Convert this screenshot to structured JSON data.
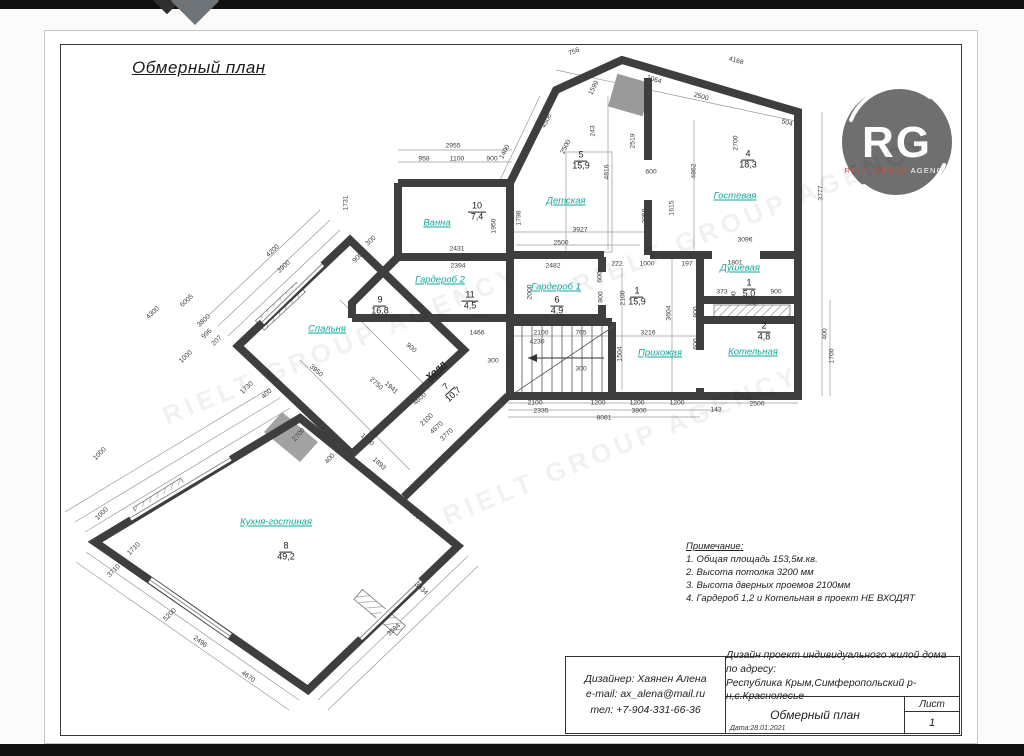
{
  "page": {
    "title": "Обмерный план"
  },
  "logo": {
    "initials": "RG",
    "line1": "RIELT GROUP",
    "line2": " AGENCY",
    "circle_color": "#6f6f6f",
    "accent_color": "#cf4d42"
  },
  "watermark": {
    "text": "RIELT GROUP AGENCY"
  },
  "colors": {
    "wall": "#3e3e3e",
    "room_label": "#12a89a",
    "thin_line": "#8a8a8a"
  },
  "notes": {
    "heading": "Примечание:",
    "items": [
      "1. Общая площадь  153,5м.кв.",
      "2. Высота потолка 3200 мм",
      "3.  Высота дверных проемов 2100мм",
      "4. Гардероб 1,2 и Котельная в проект НЕ ВХОДЯТ"
    ]
  },
  "titleblock": {
    "designer_lines": [
      "Дизайнер: Хаянен Алена",
      "e-mail: ax_alena@mail.ru",
      "тел: +7-904-331-66-36"
    ],
    "project_lines": [
      "Дизайн проект индивидуального жилой дома по адресу:",
      "Республика Крым,Симферопольский р-н,с.Краснолесье"
    ],
    "doc_title": "Обмерный план",
    "date_label": "Дата:28.01.2021",
    "sheet_label": "Лист",
    "sheet_number": "1"
  },
  "plan": {
    "rooms": [
      {
        "name": "Ванна",
        "number": "10",
        "area": "7,4",
        "lx": 437,
        "ly": 223,
        "fx": 477,
        "fy": 212,
        "rot": 0,
        "color": "teal"
      },
      {
        "name": "Детская",
        "number": "5",
        "area": "15,9",
        "lx": 566,
        "ly": 201,
        "fx": 581,
        "fy": 161,
        "rot": 0,
        "color": "teal"
      },
      {
        "name": "Гостевая",
        "number": "4",
        "area": "18,3",
        "lx": 735,
        "ly": 196,
        "fx": 748,
        "fy": 160,
        "rot": 0,
        "color": "teal"
      },
      {
        "name": "Гардероб 2",
        "number": "11",
        "area": "4,5",
        "lx": 440,
        "ly": 280,
        "fx": 470,
        "fy": 301,
        "rot": 0,
        "color": "teal"
      },
      {
        "name": "Гардероб 1",
        "number": "6",
        "area": "4,9",
        "lx": 556,
        "ly": 287,
        "fx": 557,
        "fy": 306,
        "rot": 0,
        "color": "teal"
      },
      {
        "name": "Прихожая",
        "number": "1",
        "area": "15,9",
        "lx": 660,
        "ly": 353,
        "fx": 637,
        "fy": 297,
        "rot": 0,
        "color": "teal"
      },
      {
        "name": "Душевая",
        "number": "1",
        "area": "5,0",
        "lx": 740,
        "ly": 268,
        "fx": 749,
        "fy": 289,
        "rot": 0,
        "color": "teal"
      },
      {
        "name": "Котельная",
        "number": "2",
        "area": "4,8",
        "lx": 753,
        "ly": 352,
        "fx": 764,
        "fy": 332,
        "rot": 0,
        "color": "teal"
      },
      {
        "name": "Холл",
        "number": "7",
        "area": "10,7",
        "lx": 436,
        "ly": 371,
        "fx": 450,
        "fy": 391,
        "rot": -43,
        "color": "dark"
      },
      {
        "name": "Спальня",
        "number": "9",
        "area": "16,8",
        "lx": 327,
        "ly": 329,
        "fx": 380,
        "fy": 306,
        "rot": 0,
        "color": "teal"
      },
      {
        "name": "Кухня-гостиная",
        "number": "8",
        "area": "49,2",
        "lx": 276,
        "ly": 522,
        "fx": 286,
        "fy": 552,
        "rot": 0,
        "color": "teal"
      }
    ],
    "dimensions": [
      [
        "756",
        574,
        52,
        -22
      ],
      [
        "1064",
        654,
        80,
        16
      ],
      [
        "4168",
        736,
        61,
        16
      ],
      [
        "2500",
        701,
        97,
        16
      ],
      [
        "504",
        787,
        123,
        16
      ],
      [
        "1400",
        505,
        152,
        -63
      ],
      [
        "1599",
        594,
        88,
        -63
      ],
      [
        "4506",
        547,
        121,
        -63
      ],
      [
        "2500",
        566,
        147,
        -63
      ],
      [
        "243",
        593,
        131,
        -90
      ],
      [
        "2519",
        633,
        141,
        -90
      ],
      [
        "2700",
        736,
        143,
        -90
      ],
      [
        "4862",
        694,
        171,
        -90
      ],
      [
        "4816",
        607,
        172,
        -90
      ],
      [
        "3777",
        821,
        193,
        -90
      ],
      [
        "600",
        651,
        172,
        0
      ],
      [
        "1615",
        672,
        208,
        -90
      ],
      [
        "2058",
        645,
        216,
        -90
      ],
      [
        "1798",
        519,
        218,
        -90
      ],
      [
        "3927",
        580,
        230,
        0
      ],
      [
        "2500",
        561,
        243,
        0
      ],
      [
        "3096",
        745,
        240,
        0
      ],
      [
        "2955",
        453,
        146,
        0
      ],
      [
        "958",
        424,
        159,
        0
      ],
      [
        "1100",
        457,
        159,
        0
      ],
      [
        "900",
        492,
        159,
        0
      ],
      [
        "1731",
        346,
        203,
        -90
      ],
      [
        "300",
        371,
        241,
        -45
      ],
      [
        "900",
        358,
        258,
        -45
      ],
      [
        "2431",
        457,
        249,
        0
      ],
      [
        "2394",
        458,
        266,
        0
      ],
      [
        "1950",
        494,
        226,
        -90
      ],
      [
        "2482",
        553,
        266,
        0
      ],
      [
        "2039",
        511,
        292,
        -90
      ],
      [
        "2000",
        530,
        292,
        -90
      ],
      [
        "1308",
        479,
        318,
        0
      ],
      [
        "600",
        600,
        277,
        -90
      ],
      [
        "800",
        601,
        297,
        -90
      ],
      [
        "222",
        617,
        264,
        0
      ],
      [
        "1000",
        647,
        264,
        0
      ],
      [
        "197",
        687,
        264,
        0
      ],
      [
        "1801",
        735,
        263,
        0
      ],
      [
        "2100",
        623,
        298,
        -90
      ],
      [
        "3604",
        669,
        313,
        -90
      ],
      [
        "3216",
        648,
        333,
        0
      ],
      [
        "1504",
        620,
        354,
        -90
      ],
      [
        "800",
        696,
        312,
        -90
      ],
      [
        "600",
        696,
        344,
        -90
      ],
      [
        "373",
        722,
        292,
        0
      ],
      [
        "930",
        752,
        304,
        0
      ],
      [
        "900",
        776,
        292,
        0
      ],
      [
        "100",
        778,
        301,
        0
      ],
      [
        "200",
        734,
        297,
        -90
      ],
      [
        "400",
        825,
        334,
        -90
      ],
      [
        "1700",
        832,
        356,
        -90
      ],
      [
        "1466",
        477,
        333,
        0
      ],
      [
        "2100",
        541,
        333,
        0
      ],
      [
        "765",
        581,
        333,
        0
      ],
      [
        "4230",
        537,
        342,
        0
      ],
      [
        "1504",
        512,
        356,
        -90
      ],
      [
        "300",
        493,
        361,
        0
      ],
      [
        "300",
        581,
        369,
        0
      ],
      [
        "2100",
        535,
        403,
        0
      ],
      [
        "2335",
        541,
        411,
        0
      ],
      [
        "1200",
        598,
        403,
        0
      ],
      [
        "1200",
        637,
        403,
        0
      ],
      [
        "1200",
        677,
        403,
        0
      ],
      [
        "3800",
        639,
        411,
        0
      ],
      [
        "143",
        716,
        410,
        0
      ],
      [
        "8081",
        604,
        418,
        0
      ],
      [
        "2500",
        757,
        404,
        0
      ],
      [
        "4200",
        273,
        251,
        -43
      ],
      [
        "3900",
        284,
        267,
        -43
      ],
      [
        "6005",
        187,
        301,
        -43
      ],
      [
        "3800",
        204,
        321,
        -43
      ],
      [
        "4300",
        153,
        313,
        -43
      ],
      [
        "996",
        207,
        334,
        -43
      ],
      [
        "207",
        217,
        341,
        -43
      ],
      [
        "1000",
        186,
        357,
        -43
      ],
      [
        "1730",
        247,
        388,
        -43
      ],
      [
        "400",
        267,
        394,
        -43
      ],
      [
        "3950",
        316,
        371,
        42
      ],
      [
        "2750",
        376,
        384,
        42
      ],
      [
        "1941",
        391,
        388,
        42
      ],
      [
        "900",
        411,
        348,
        42
      ],
      [
        "4600",
        420,
        399,
        -43
      ],
      [
        "2100",
        427,
        420,
        -43
      ],
      [
        "4570",
        437,
        428,
        -43
      ],
      [
        "3770",
        447,
        435,
        -43
      ],
      [
        "1000",
        100,
        454,
        -45
      ],
      [
        "1000",
        102,
        514,
        -45
      ],
      [
        "1710",
        134,
        549,
        -45
      ],
      [
        "3710",
        114,
        571,
        -45
      ],
      [
        "5200",
        170,
        615,
        -45
      ],
      [
        "2700",
        299,
        435,
        -48
      ],
      [
        "400",
        330,
        459,
        -48
      ],
      [
        "1600",
        367,
        440,
        42
      ],
      [
        "1893",
        379,
        464,
        42
      ],
      [
        "396",
        385,
        488,
        42
      ],
      [
        "2004",
        416,
        516,
        42
      ],
      [
        "3834",
        421,
        589,
        42
      ],
      [
        "2496",
        200,
        642,
        36
      ],
      [
        "4670",
        248,
        677,
        36
      ],
      [
        "3594",
        394,
        630,
        -42
      ]
    ]
  }
}
